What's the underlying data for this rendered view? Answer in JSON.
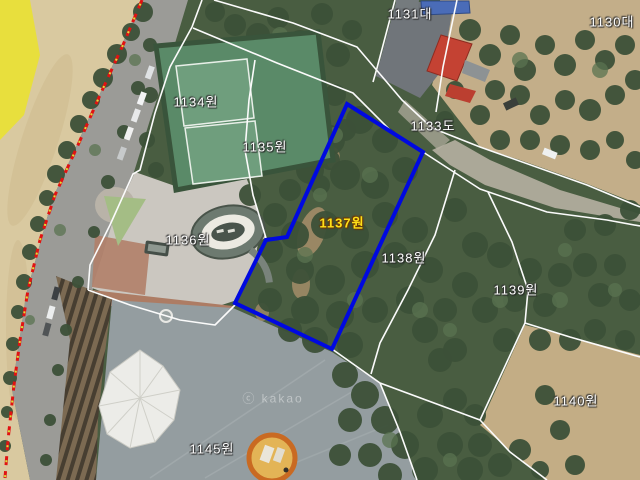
{
  "map": {
    "attribution": "ⓒ kakao",
    "label_color": "#ffffff",
    "selected_label_color": "#ffe118",
    "boundary_color": "#fbfbfb",
    "highlight_color": "#0009e0",
    "coastline_color": "#e11212",
    "parcels": [
      {
        "label": "1131대",
        "x": 410,
        "y": 13,
        "selected": false
      },
      {
        "label": "1130대",
        "x": 612,
        "y": 21,
        "selected": false
      },
      {
        "label": "1133도",
        "x": 433,
        "y": 125,
        "selected": false
      },
      {
        "label": "1134원",
        "x": 196,
        "y": 101,
        "selected": false
      },
      {
        "label": "1135원",
        "x": 265,
        "y": 146,
        "selected": false
      },
      {
        "label": "1136원",
        "x": 188,
        "y": 239,
        "selected": false
      },
      {
        "label": "1137원",
        "x": 342,
        "y": 222,
        "selected": true
      },
      {
        "label": "1138원",
        "x": 404,
        "y": 257,
        "selected": false
      },
      {
        "label": "1139원",
        "x": 516,
        "y": 289,
        "selected": false
      },
      {
        "label": "1140원",
        "x": 576,
        "y": 400,
        "selected": false
      },
      {
        "label": "1145원",
        "x": 212,
        "y": 448,
        "selected": false
      }
    ],
    "highlighted_parcel": {
      "label": "1137원",
      "outline_points": "347,104 423,152 332,349 235,303 266,240 287,237"
    }
  }
}
